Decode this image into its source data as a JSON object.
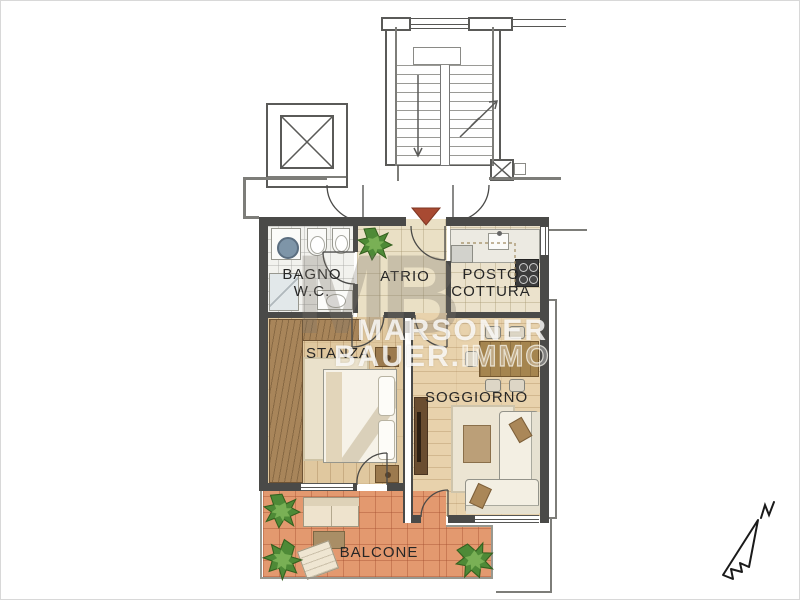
{
  "floor_plan": {
    "rooms": {
      "bagno": {
        "label_line1": "BAGNO",
        "label_line2": "W.C."
      },
      "atrio": {
        "label": "ATRIO"
      },
      "posto_cottura": {
        "label_line1": "POSTO",
        "label_line2": "COTTURA"
      },
      "stanza": {
        "label": "STANZA"
      },
      "soggiorno": {
        "label": "SOGGIORNO"
      },
      "balcone": {
        "label": "BALCONE"
      }
    },
    "watermark": {
      "monogram": "MB",
      "line1": "MARSONER",
      "line2_bold": "BAUER.",
      "line2_light": "IMMO"
    },
    "compass": {
      "north": "N"
    },
    "colors": {
      "wall": "#4a4a48",
      "stanza_floor": "#e0c89f",
      "soggiorno_floor": "#e8d2ac",
      "atrio_floor": "#eae0c5",
      "bagno_floor": "#f2f2ee",
      "cottura_floor": "#ebe2cc",
      "balcone_floor": "#e3996f",
      "entrance_marker": "#a84a32",
      "plant_green": "#4e8a37",
      "wardrobe_brown": "#a8855a"
    }
  }
}
